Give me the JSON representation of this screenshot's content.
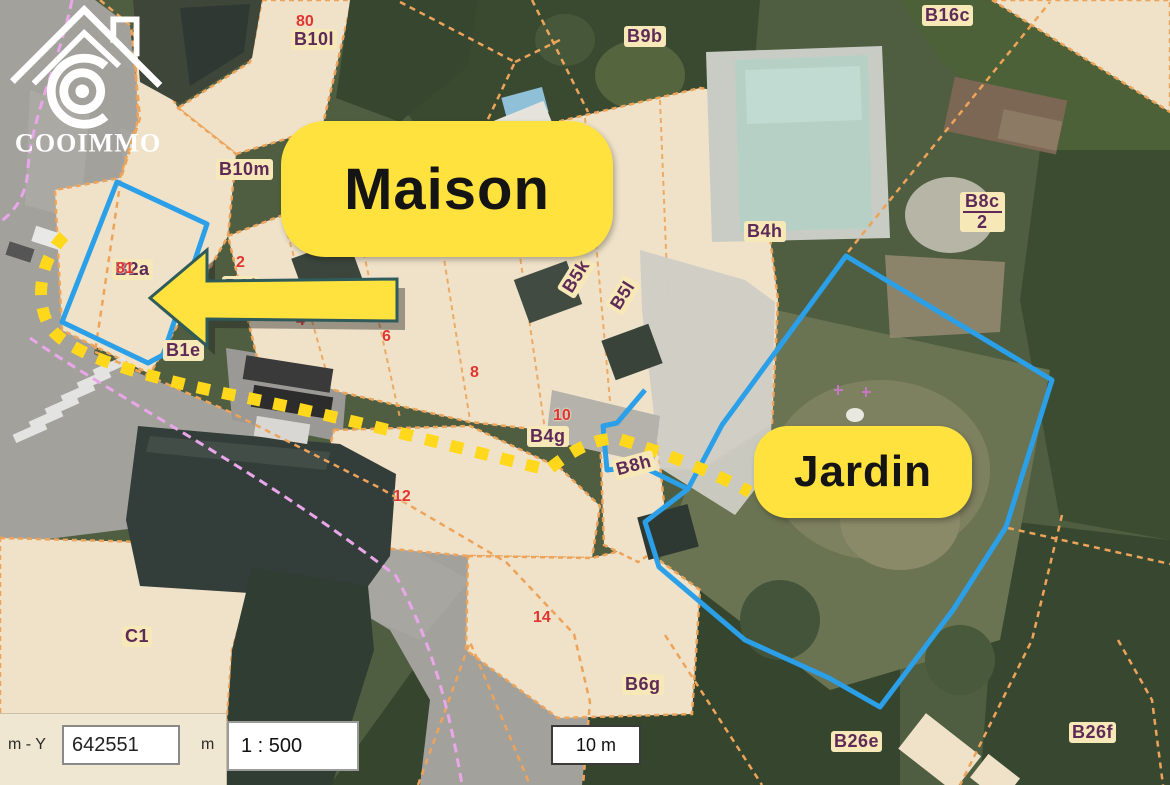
{
  "map": {
    "callouts": {
      "maison": "Maison",
      "jardin": "Jardin"
    },
    "parcel_labels": [
      {
        "text": "B10l"
      },
      {
        "text": "B10m"
      },
      {
        "text": "B9b"
      },
      {
        "text": "B16c"
      },
      {
        "text": "B4h"
      },
      {
        "text": "B5k"
      },
      {
        "text": "B5l"
      },
      {
        "text": "B1f"
      },
      {
        "text": "B2a"
      },
      {
        "text": "B1e"
      },
      {
        "text": "B4g"
      },
      {
        "text": "B8h"
      },
      {
        "text": "C1"
      },
      {
        "text": "B6g"
      },
      {
        "text": "B26e"
      },
      {
        "text": "B26f"
      }
    ],
    "fraction_label": {
      "numerator": "B8c",
      "denominator": "2"
    },
    "lot_numbers": [
      {
        "text": "80"
      },
      {
        "text": "81"
      },
      {
        "text": "2"
      },
      {
        "text": "4"
      },
      {
        "text": "6"
      },
      {
        "text": "8"
      },
      {
        "text": "10"
      },
      {
        "text": "12"
      },
      {
        "text": "14"
      }
    ],
    "colors": {
      "highlight_yellow": "#FFE23E",
      "selection_blue": "#2B9FE8",
      "cadastre_orange": "#EDA45A",
      "boundary_violet": "#E9A6E9",
      "parcel_label": "#5E2A57",
      "lot_number_red": "#E03434",
      "parcel_beige": "#EFE2C8"
    },
    "watermark": {
      "brand": "COOIMMO"
    }
  },
  "toolbar": {
    "coord_label": "m - Y",
    "coord_value": "642551",
    "coord_unit": "m",
    "scale": "1 : 500",
    "scalebar": "10 m"
  }
}
